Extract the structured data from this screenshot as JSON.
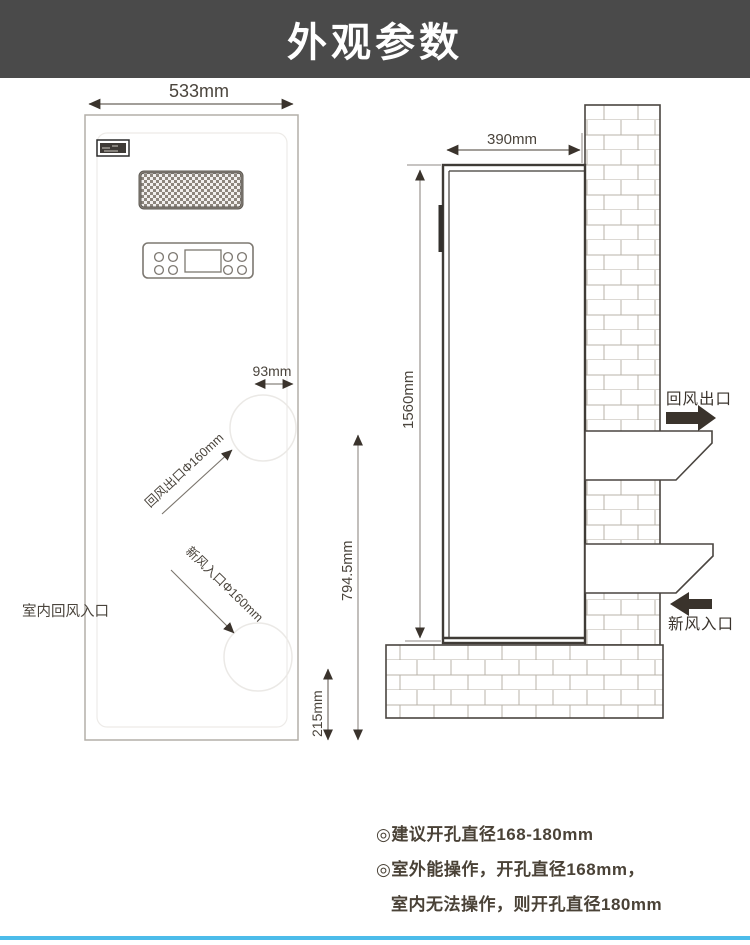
{
  "header": {
    "title": "外观参数"
  },
  "front_view": {
    "width": "533mm",
    "grille_hole_offset": "93mm",
    "return_air_outlet": "回风出口Φ160mm",
    "fresh_air_inlet": "新风入口Φ160mm",
    "indoor_return_inlet": "室内回风入口",
    "bottom_port_height": "215mm"
  },
  "side_view": {
    "depth": "390mm",
    "height": "1560mm",
    "outlet_center_height": "794.5mm",
    "return_air_outlet": "回风出口",
    "fresh_air_inlet": "新风入口"
  },
  "notes": [
    "◎建议开孔直径168-180mm",
    "◎室外能操作，开孔直径168mm，",
    "室内无法操作，则开孔直径180mm"
  ],
  "colors": {
    "header_bg": "#4a4a4a",
    "accent_bar": "#4cbcea",
    "ink": "#4a443c",
    "line": "#8f8a84"
  }
}
